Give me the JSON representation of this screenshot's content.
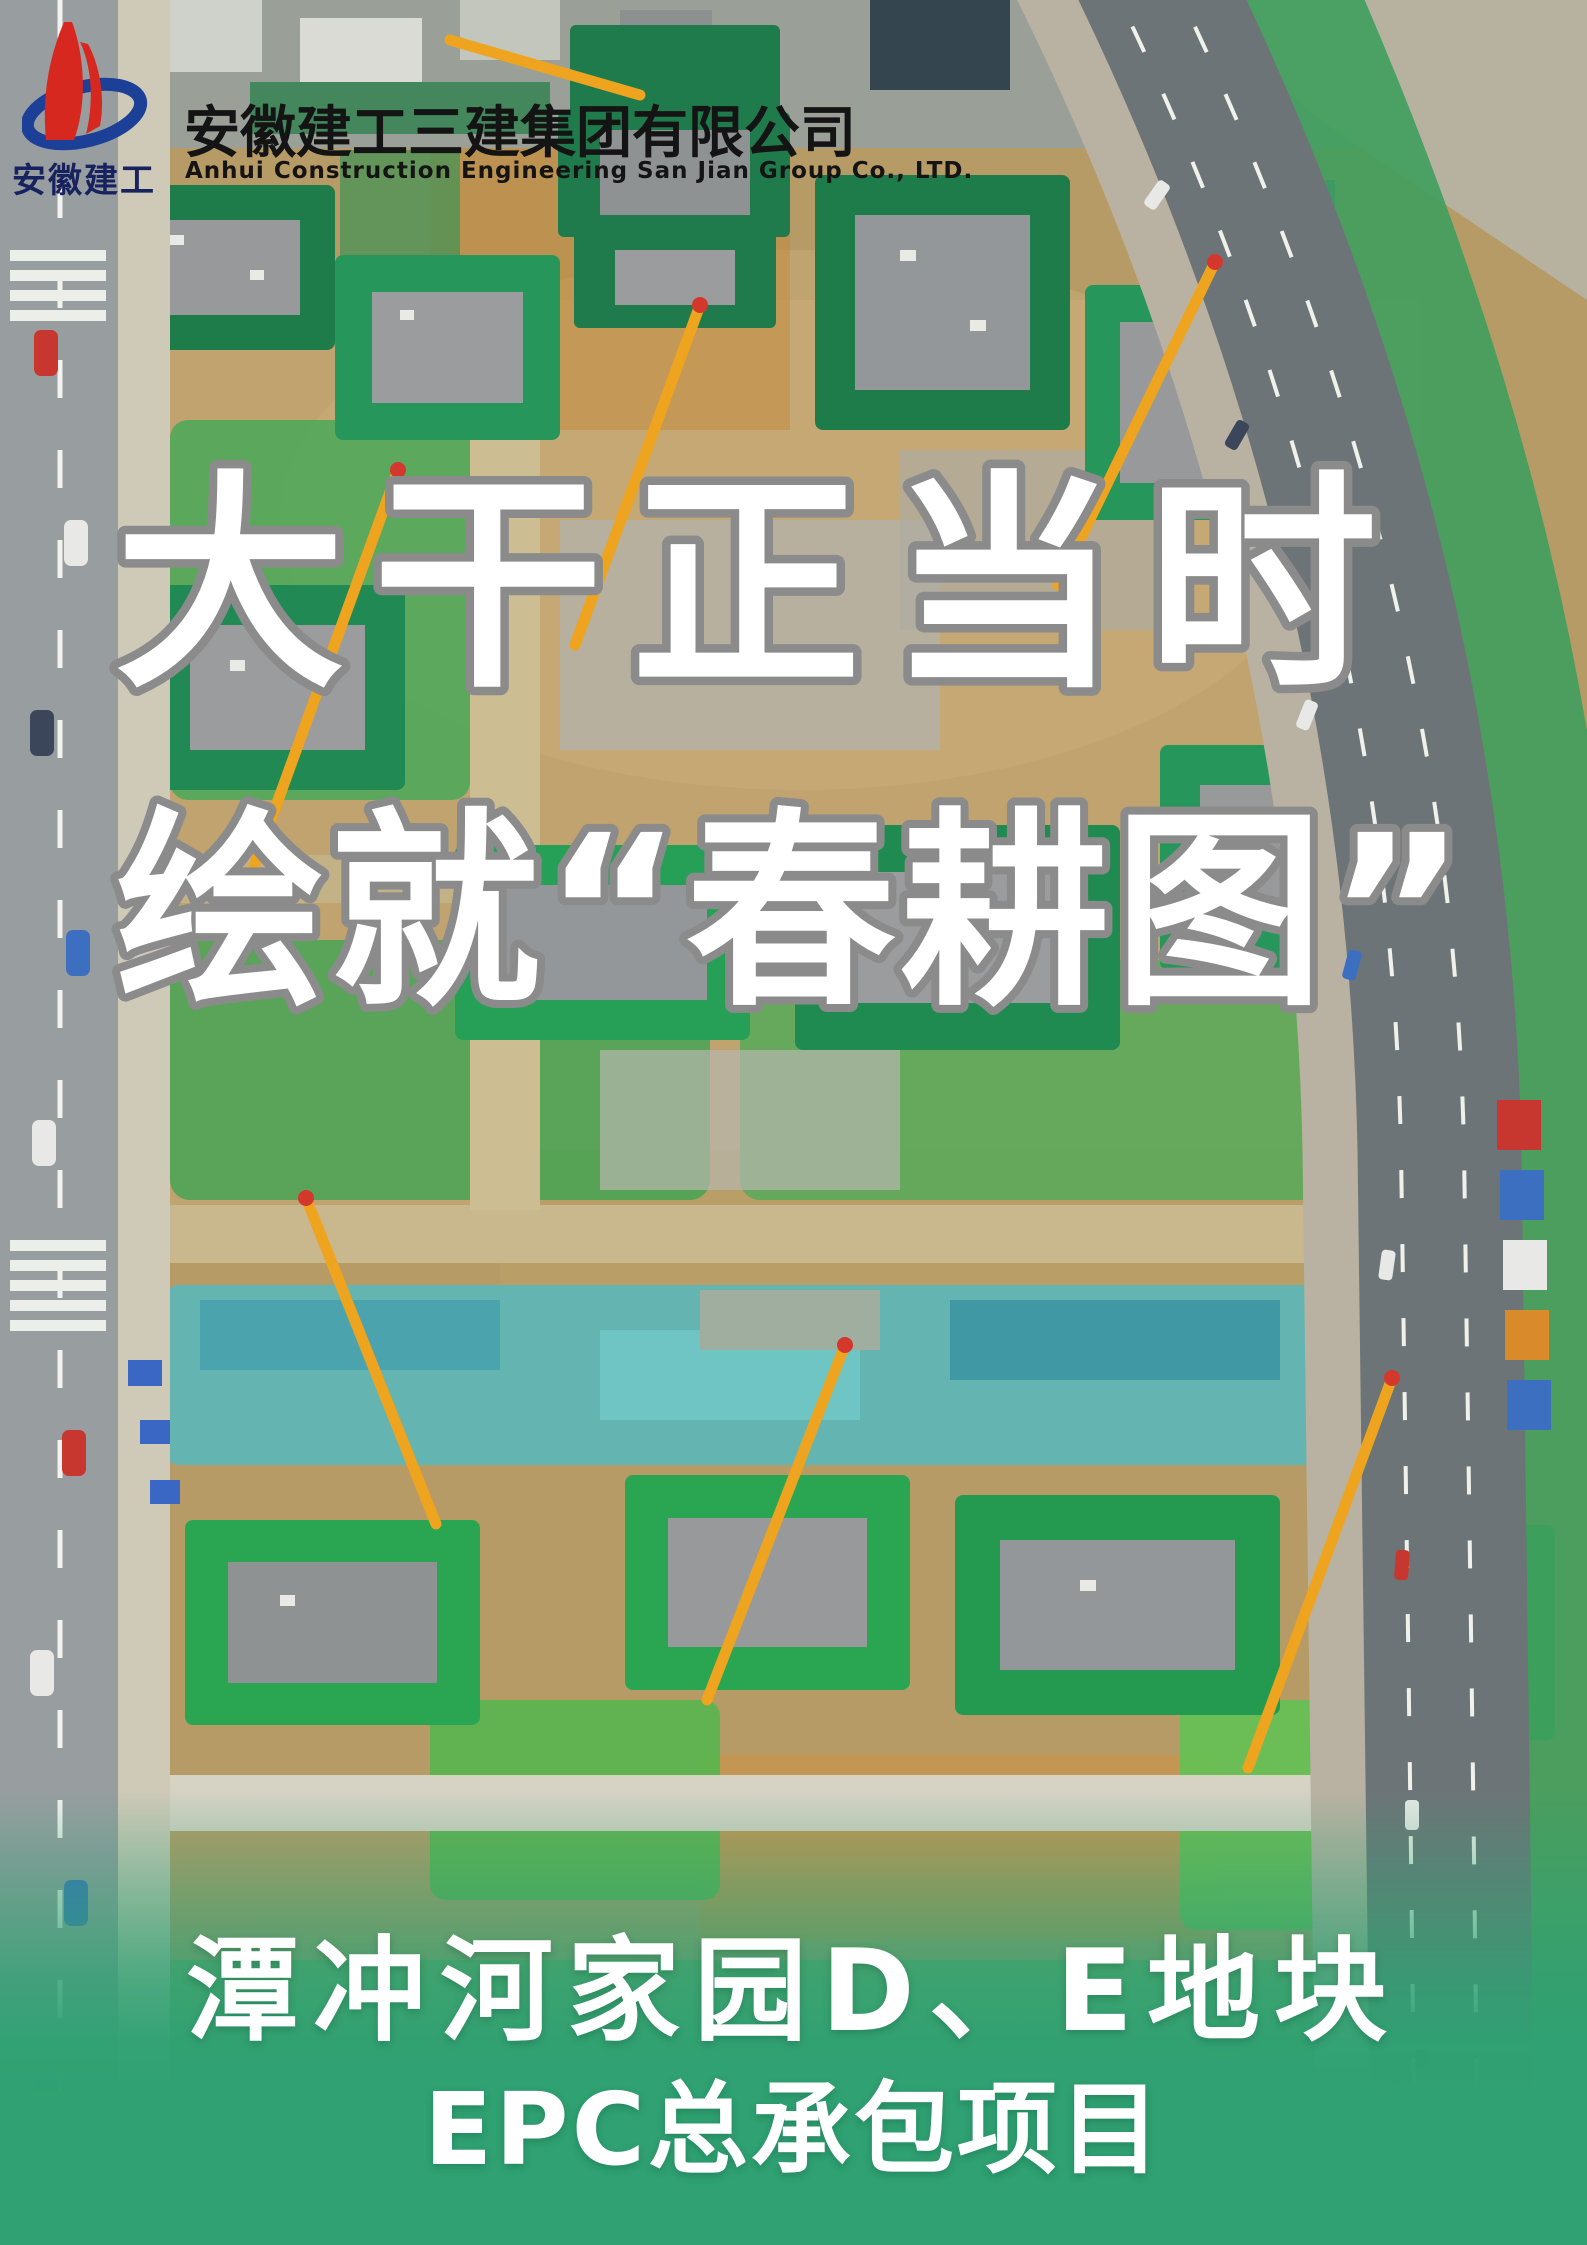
{
  "meta": {
    "kind": "construction-company poster",
    "width_px": 1587,
    "height_px": 2245
  },
  "colors": {
    "brand-red": "#d7281f",
    "brand-blue": "#1c3f97",
    "wordmark-navy": "#17225f",
    "title-black": "#141414",
    "headline-white": "#ffffff",
    "headline-outline": "#8b8b8b",
    "band-green": "#2fa173",
    "netting-green": "#27a04f",
    "crane-yellow": "#eea41e"
  },
  "header": {
    "logo_caption": "安徽建工",
    "company_name_cn": "安徽建工三建集团有限公司",
    "company_name_en": "Anhui Construction Engineering San Jian Group Co., LTD."
  },
  "headline": {
    "line1": "大干正当时",
    "line2": "绘就“春耕图”"
  },
  "footer": {
    "line1": "潭冲河家园D、E地块",
    "line2": "EPC总承包项目"
  },
  "scene": {
    "description": "Aerial drone photo of a large residential construction site: tower blocks wrapped in green safety netting, yellow tower cranes, earthen ground, teal tarp-covered excavation, city road with crosswalk on the left and a curved multi-lane highway on the right."
  }
}
